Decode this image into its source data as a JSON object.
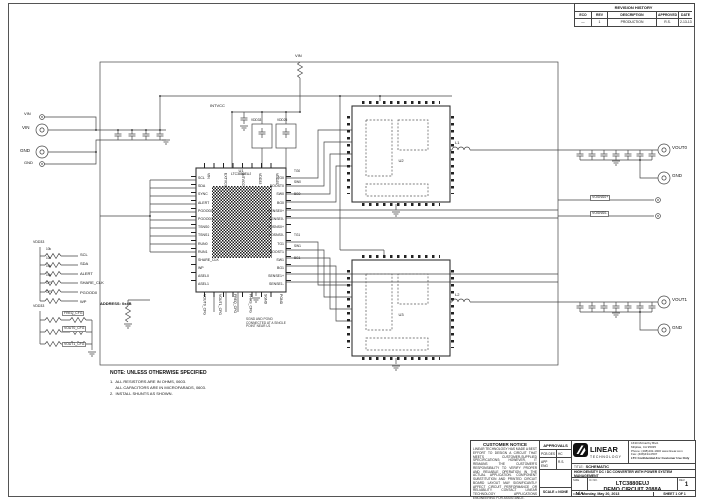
{
  "page": {
    "bg": "#ffffff",
    "line_color": "#444444"
  },
  "revision_history": {
    "title": "REVISION HISTORY",
    "columns": [
      "ECO",
      "REV",
      "DESCRIPTION",
      "APPROVED",
      "DATE"
    ],
    "row": {
      "eco": "—",
      "rev": "1",
      "description": "PRODUCTION",
      "approved": "R.S.",
      "date": "2-13-13"
    }
  },
  "notes": {
    "title": "NOTE: UNLESS OTHERWISE SPECIFIED",
    "lines": [
      "1.  ALL RESISTORS ARE IN OHMS, 0603.",
      "     ALL CAPACITORS ARE IN MICROFARADS, 0603.",
      "2.  INSTALL SHUNTS AS SHOWN."
    ]
  },
  "schematic": {
    "input": {
      "vin_sense": "VIN",
      "vin": "VIN",
      "gnd": "GND",
      "gnd2": "GND"
    },
    "rails": {
      "intvcc": "INTVCC",
      "vdd33": "VDD33",
      "vdd25": "VDD25",
      "vin_top": "VIN"
    },
    "u1": {
      "ref": "U1",
      "part": "LTC3880EUJ",
      "address": "ADDRESS: 0x4B",
      "left_pins": [
        "SCL",
        "SDA",
        "SYNC",
        "ALERT",
        "PGOOD0",
        "PGOOD1",
        "TSNS0",
        "TSNS1",
        "RUN0",
        "RUN1",
        "SHARE_CLK",
        "WP",
        "ASEL0",
        "ASEL1"
      ],
      "right_pins": [
        "TG0",
        "BOOST0",
        "SW0",
        "BG0",
        "SENSE0+",
        "SENSE0-",
        "VOSNS0+",
        "VOSNS0-",
        "TG1",
        "BOOST1",
        "SW1",
        "BG1",
        "SENSE1+",
        "SENSE1-"
      ],
      "top_pins": [
        "VIN",
        "EXTVCC",
        "INTVCC",
        "VDD33",
        "VDD25"
      ],
      "bottom_pins": [
        "VOUT0_CFG",
        "VOUT1_CFG",
        "FREQ_CFG",
        "PHAS_CFG",
        "SGND",
        "PGND"
      ],
      "gnd_note": "SGND AND PGND CONNECTED AT A SINGLE POINT NEAR U1"
    },
    "u2": {
      "ref": "U2"
    },
    "u3": {
      "ref": "U3"
    },
    "l1": "L1",
    "l2": "L2",
    "pullups": {
      "rail": "VDD33",
      "values": [
        "10k",
        "10k",
        "10k",
        "10k",
        "OPT",
        "OPT"
      ],
      "nets": [
        "SCL",
        "SDA",
        "ALERT",
        "SHARE_CLK",
        "PGOOD0",
        "WP"
      ]
    },
    "config": {
      "rail": "VDD33",
      "nets": [
        "FREQ_CFG",
        "VOUT0_CFG",
        "VOUT1_CFG"
      ]
    },
    "ch0_nets": [
      "TG0",
      "SW0",
      "BG0"
    ],
    "ch1_nets": [
      "TG1",
      "SW1",
      "BG1"
    ],
    "output": {
      "vout0": "VOUT0",
      "gnd0": "GND",
      "vosns0p": "VOSNS0+",
      "vosns0n": "VOSNS0-",
      "vout1": "VOUT1",
      "gnd1": "GND"
    }
  },
  "customer_notice": {
    "title": "CUSTOMER NOTICE",
    "body": "LINEAR TECHNOLOGY HAS MADE A BEST EFFORT TO DESIGN A CIRCUIT THAT MEETS CUSTOMER-SUPPLIED SPECIFICATIONS; HOWEVER, IT REMAINS THE CUSTOMER'S RESPONSIBILITY TO VERIFY PROPER AND RELIABLE OPERATION IN THE ACTUAL APPLICATION. COMPONENT SUBSTITUTION AND PRINTED CIRCUIT BOARD LAYOUT MAY SIGNIFICANTLY AFFECT CIRCUIT PERFORMANCE OR RELIABILITY. CONTACT LINEAR TECHNOLOGY APPLICATIONS ENGINEERING FOR ASSISTANCE.",
    "footer": "THIS CIRCUIT IS PROPRIETARY TO LINEAR TECHNOLOGY AND SUPPLIED FOR USE WITH LINEAR TECHNOLOGY PARTS."
  },
  "approvals": {
    "title": "APPROVALS",
    "rows": [
      {
        "label": "PCB DES",
        "value": "HC"
      },
      {
        "label": "APP ENG",
        "value": "R.S."
      }
    ],
    "scale": "SCALE = NONE"
  },
  "title_block": {
    "logo_line1": "LINEAR",
    "logo_line2": "TECHNOLOGY",
    "address": [
      "1630 McCarthy Blvd.",
      "Milpitas, CA 95035",
      "Phone: (408)432-1900   www.linear.com",
      "Fax: (408)434-0507",
      "LTC Confidential-For Customer Use Only"
    ],
    "title_label": "TITLE:",
    "title": "SCHEMATIC",
    "subtitle": "HIGH DENSITY DC / DC CONVERTER WITH POWER SYSTEM MANAGEMENT",
    "size_label": "SIZE",
    "size": "N/A",
    "icno_label": "IC NO.",
    "part": "LTC3880EUJ",
    "circuit": "DEMO CIRCUIT 2088A",
    "rev_label": "REV.",
    "rev": "1",
    "date_label": "DATE:",
    "date": "Monday, May 20, 2013",
    "sheet": "SHEET  1  OF  1"
  }
}
